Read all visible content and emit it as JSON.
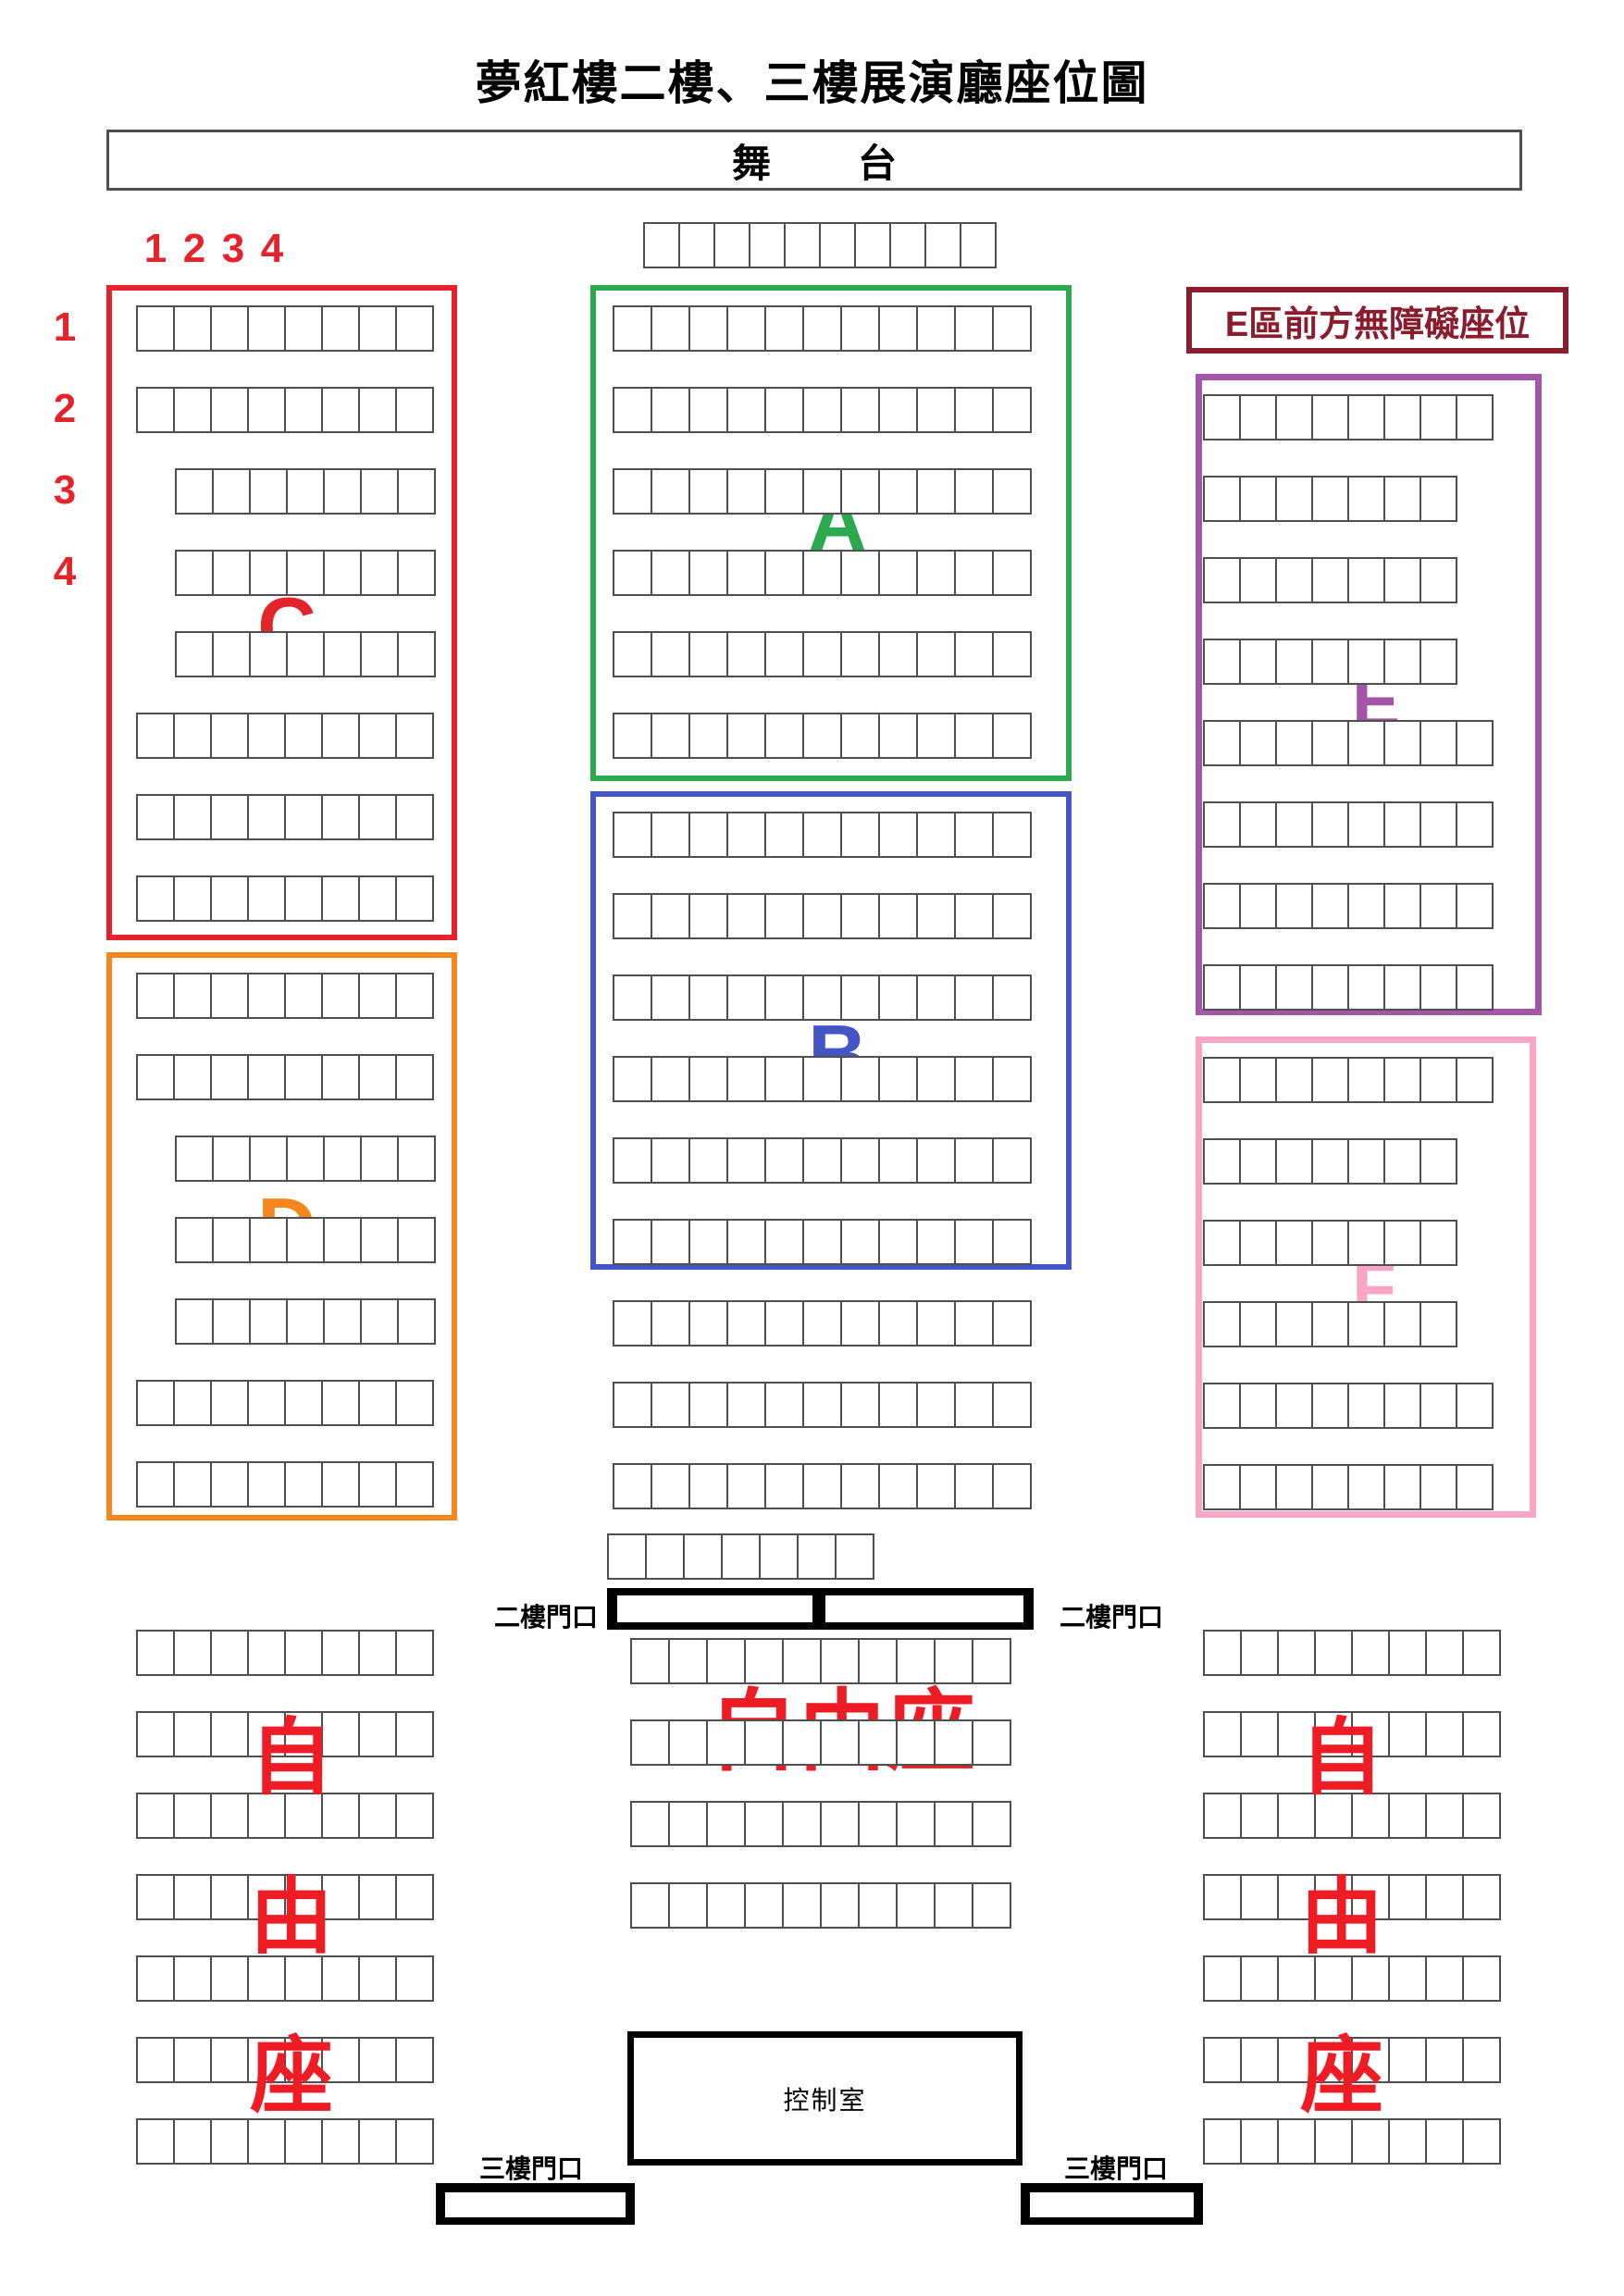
{
  "page": {
    "title": "夢紅樓二樓、三樓展演廳座位圖"
  },
  "stage": {
    "label": "舞　台"
  },
  "guides": {
    "column_numbers": [
      "1",
      "2",
      "3",
      "4"
    ],
    "row_numbers": [
      "1",
      "2",
      "3",
      "4"
    ],
    "color": "#e3242b"
  },
  "sections": {
    "A": {
      "label": "A",
      "color": "#2ca94e",
      "rows": [
        11,
        11,
        11,
        11,
        11,
        11
      ]
    },
    "B": {
      "label": "B",
      "color": "#4456c5",
      "rows": [
        11,
        11,
        11,
        11,
        11,
        11
      ]
    },
    "C": {
      "label": "C",
      "color": "#e3242b",
      "rows": [
        8,
        8,
        7,
        7,
        7,
        8,
        8,
        8
      ]
    },
    "D": {
      "label": "D",
      "color": "#f6871f",
      "rows": [
        8,
        8,
        7,
        7,
        7,
        8,
        8
      ]
    },
    "E": {
      "label": "E",
      "color": "#a355a8",
      "rows": [
        8,
        7,
        7,
        7,
        8,
        8,
        8,
        8
      ]
    },
    "F": {
      "label": "F",
      "color": "#f9a6c5",
      "rows": [
        8,
        7,
        7,
        7,
        8,
        8
      ]
    }
  },
  "open_seating_rows": {
    "stage_front": [
      10
    ],
    "below_b": [
      11,
      11,
      11
    ],
    "mid_small": [
      7
    ],
    "center_bottom": [
      10,
      10,
      10,
      10
    ],
    "left_free": [
      8,
      8,
      8,
      8,
      8,
      8,
      8
    ],
    "right_free": [
      8,
      8,
      8,
      8,
      8,
      8,
      8
    ]
  },
  "labels": {
    "e_accessible": "E區前方無障礙座位",
    "e_accessible_color": "#8b1c2e",
    "free_seating": "自由座",
    "free_seating_color": "#ee1c25",
    "entrance_2f": "二樓門口",
    "entrance_3f": "三樓門口",
    "control_room": "控制室"
  },
  "colors": {
    "seat_border": "#4f4f4f",
    "stage_border": "#4f4f4f",
    "door_black": "#000000",
    "background": "#ffffff"
  }
}
